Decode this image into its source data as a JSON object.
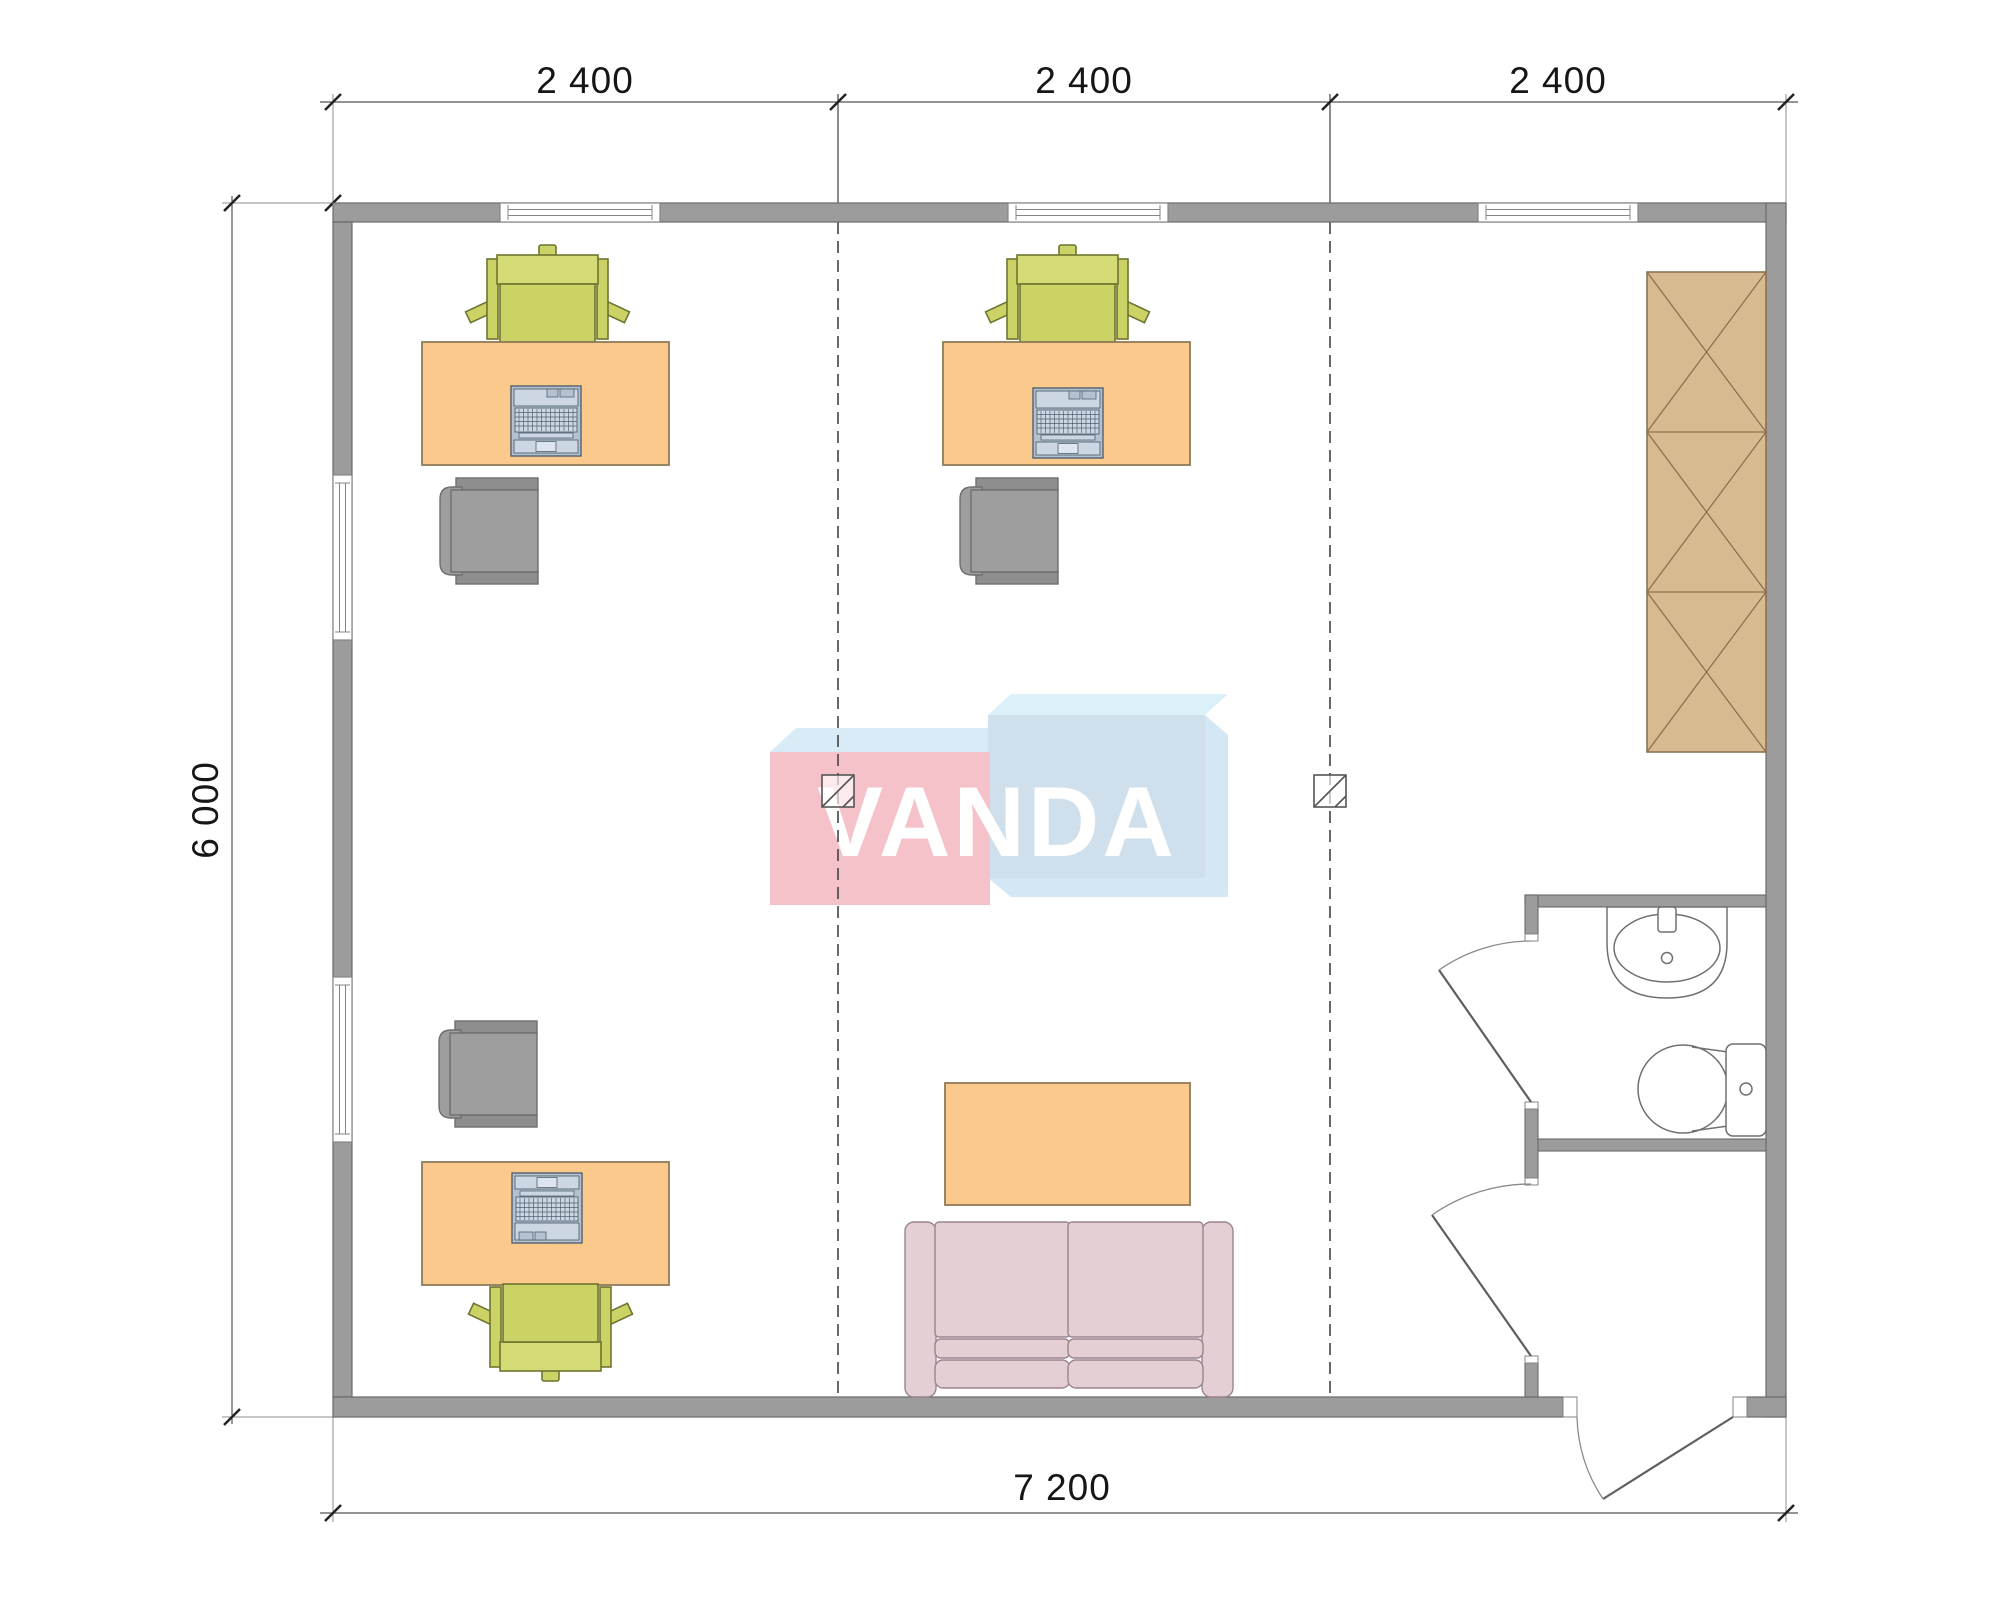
{
  "title": "office floor plan",
  "dimensions": {
    "top": [
      "2 400",
      "2 400",
      "2 400"
    ],
    "left": "6 000",
    "bottom": "7 200"
  },
  "watermark": {
    "text": "VANDA"
  },
  "objects": {
    "workstations": 3,
    "items": [
      "desk",
      "task-chair",
      "visitor-chair",
      "laptop",
      "wardrobe",
      "sofa",
      "coffee-table",
      "sink",
      "toilet",
      "bathroom-door",
      "vestibule-door",
      "entrance-door",
      "window",
      "column-marker",
      "grid-line"
    ]
  },
  "colors": {
    "wall": "#9c9c9c",
    "wall_outline": "#6a6a6a",
    "desk": "#fbc98c",
    "desk_outline": "#8d7b5a",
    "chair_green": "#ccd366",
    "chair_green_back": "#d4da74",
    "chair_green_outline": "#6f7430",
    "chair_gray": "#9e9e9e",
    "chair_gray_dark": "#8e8e8e",
    "chair_gray_outline": "#6e6e6e",
    "laptop_body": "#b4c1d1",
    "laptop_panel": "#cdd7e4",
    "laptop_pad": "#dde6f0",
    "laptop_outline": "#51616f",
    "wardrobe": "#d7ba90",
    "wardrobe_outline": "#8a7354",
    "sofa": "#e4cfd4",
    "sofa_outline": "#9c8490",
    "fixture_fill": "#ffffff",
    "fixture_outline": "#707070",
    "door_line": "#5f5f5f",
    "annotation": "#3a3a3a",
    "grid_line": "#444444",
    "logo_pink": "#f5c2ca",
    "logo_blue": "#cfe0ec",
    "logo_top_left": "#d8ebf6",
    "logo_top_right": "#dcf0fa",
    "logo_depth": "#d3e7f4",
    "logo_text": "#ffffff",
    "window_fill": "#ffffff",
    "window_outline": "#858585"
  }
}
